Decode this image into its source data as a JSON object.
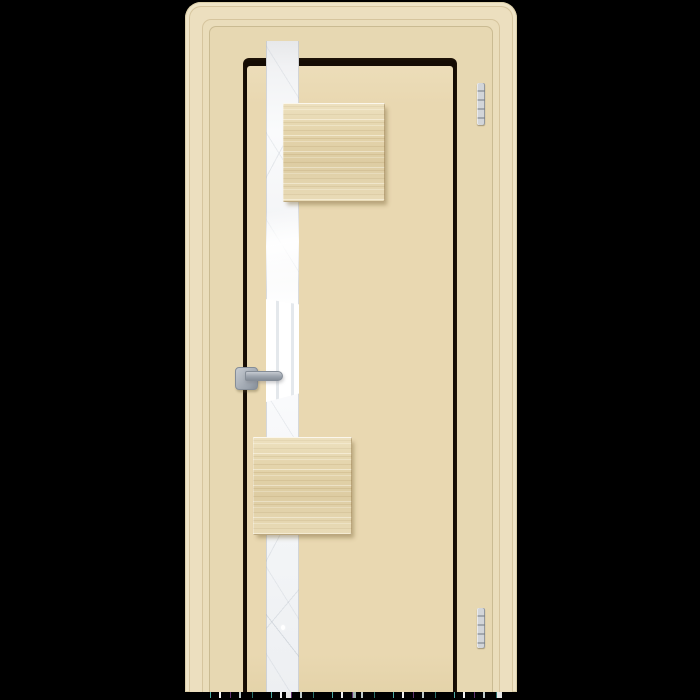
{
  "image": {
    "subject": "Product photo of a closed ivory interior door in a matching frame, with a full-height vertical mirror-glass stripe, two square light-wood overlay panels, a grey lever handle on the left and two hinges on the right, on a black background",
    "text_content": "none"
  },
  "colors": {
    "bg": "#000000",
    "frame_1": "#efe4c7",
    "frame_2": "#ecdfbf",
    "frame_3": "#eaddbb",
    "frame_4": "#e7d8b2",
    "frame_edge": "#dccfa9",
    "frame_line": "#d6c59e",
    "frame_line2": "#cabb92",
    "reveal_dark": "#6f5d42",
    "reveal_light": "#a8946e",
    "door": "#e9d8b1",
    "door_hi": "#ecddb9",
    "door_lo": "#e4d3a9",
    "wood": "#e4d4ab",
    "wood_shadow": "rgba(125,105,60,0.45)",
    "glass_white": "#ffffff",
    "mullion": "#e4e8ec",
    "metal_light": "#c6cbd1",
    "metal": "#9ba3ad",
    "metal_dark": "#858d97",
    "hinge_light": "#d2d5d9",
    "hinge_dark": "#a2a7ad"
  }
}
